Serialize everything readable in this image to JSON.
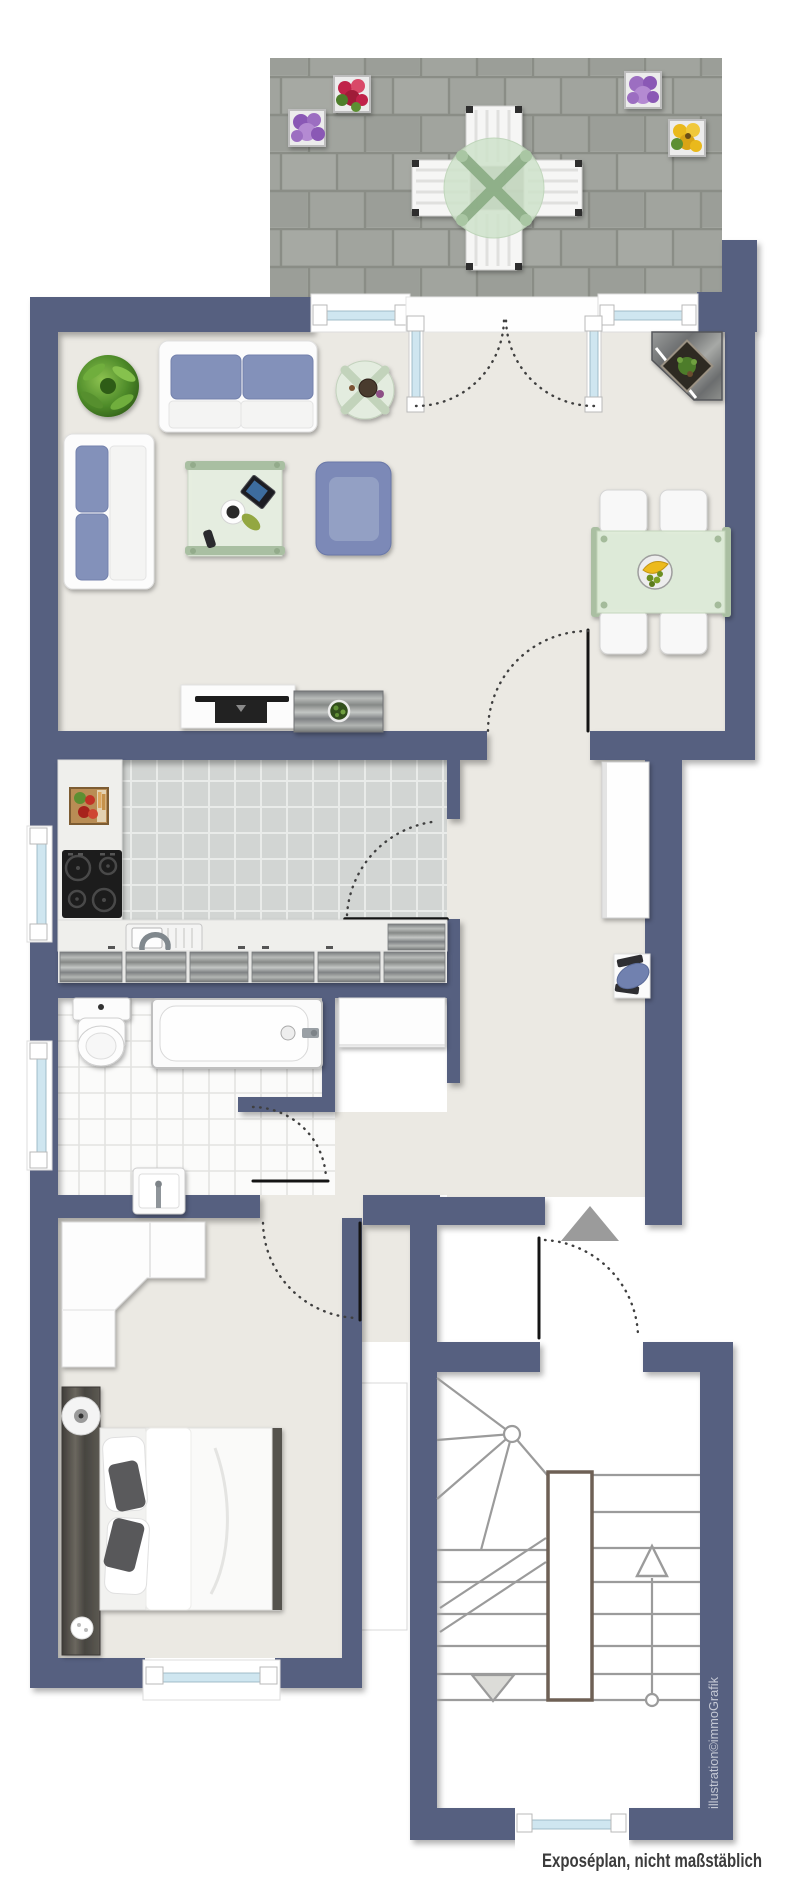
{
  "texts": {
    "caption": "Exposéplan, nicht maßstäblich",
    "watermark": "illustration©immoGrafik"
  },
  "colors": {
    "wall": "#576180",
    "floor_main": "#ebe9e3",
    "kitchen_tile": "#d2d5d3",
    "kitchen_grout": "#e9ebe9",
    "bath_tile": "#fbfbfa",
    "bath_grout": "#e3e3e1",
    "terrace_tile": "#a1a49e",
    "terrace_joint": "#8a8d86",
    "glazing": "#cfe6f0",
    "white_furniture": "#fcfcfc",
    "sofa_blue": "#8391ba",
    "armchair_blue": "#7b89b7",
    "chair_blue": "#7181af",
    "table_green": "#dfecd9",
    "cross_green": "#a8c0a0",
    "spine_brown": "#6e6055",
    "stair_line": "#9b9b9b",
    "door_line": "#141414",
    "arc_line": "#3f3f3f",
    "arrow_gray": "#9b9b9b",
    "tv_black": "#1c1c1c",
    "plant_green": "#4f8c2a",
    "pot_purple": "#9c6ec1",
    "pot_red": "#c0234a",
    "pot_yellow": "#e9b91d",
    "caption_text": "#3c3c3c",
    "watermark_text": "#c4c8d4"
  },
  "plan": {
    "type": "apartment-floor-plan",
    "rooms": [
      "terrace",
      "living-dining-room",
      "kitchen",
      "bathroom",
      "hallway",
      "bedroom",
      "stairwell"
    ],
    "furniture": [
      "terrace-table-set",
      "flower-pots",
      "sofa",
      "loveseat",
      "coffee-table",
      "side-table",
      "armchair",
      "corner-shelf",
      "dining-table-with-chairs",
      "tv-lowboard",
      "sideboard",
      "hall-cabinet",
      "desk-with-office-chair",
      "stove",
      "kitchen-sink",
      "vegetable-crate",
      "toilet",
      "bathtub",
      "washbasin",
      "wardrobe",
      "double-bed",
      "staircase"
    ]
  }
}
